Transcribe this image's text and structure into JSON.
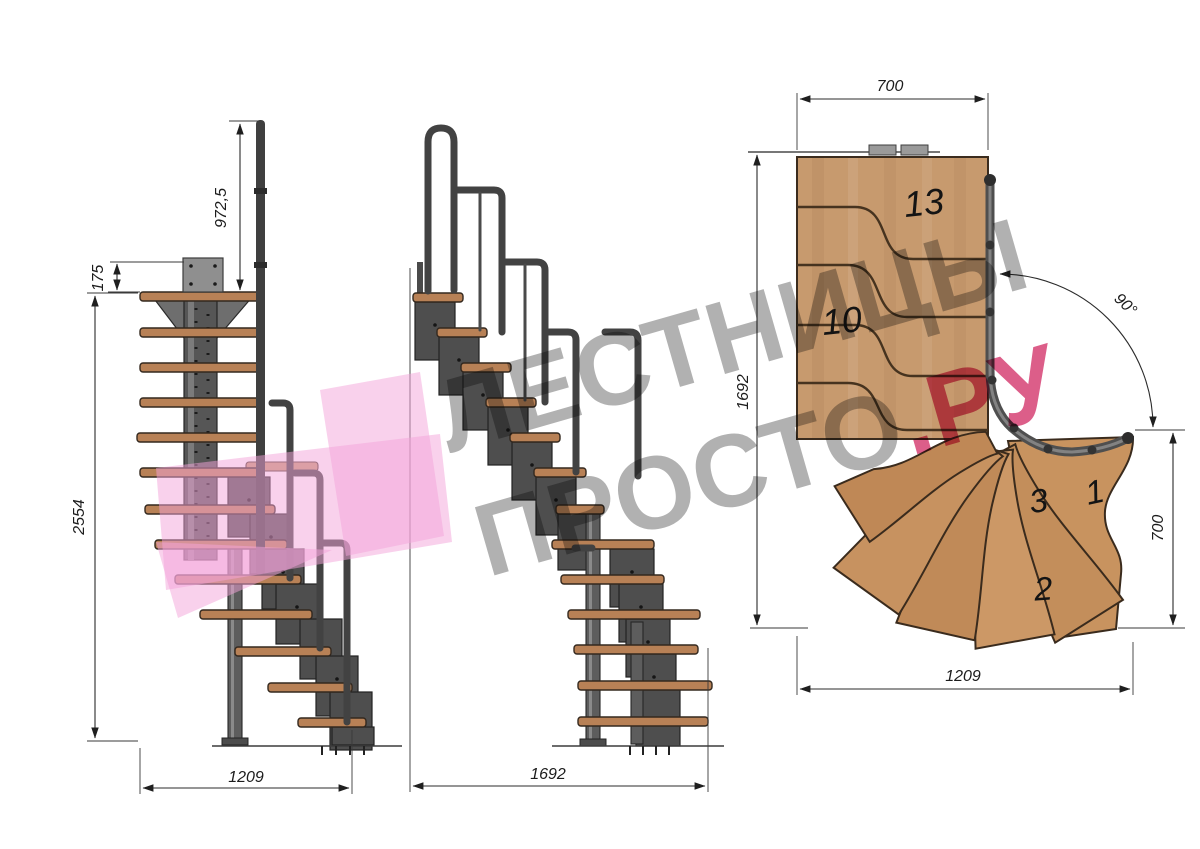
{
  "watermark": {
    "line1": "ЛЕСТНИЦЫ",
    "line2_gray": "ПРОСТО",
    "line2_pink": ".РУ"
  },
  "side_view_dims": {
    "rail_height": "972,5",
    "mount_offset": "175",
    "total_height": "2554",
    "base_width": "1209"
  },
  "front_view_dims": {
    "base_length": "1692"
  },
  "plan_dims": {
    "top_width": "700",
    "side_length": "1692",
    "bottom_width": "1209",
    "right_width": "700",
    "turn_angle": "90°"
  },
  "plan_tread_numbers": {
    "t13": "13",
    "t10": "10",
    "t3": "3",
    "t1": "1",
    "t2": "2"
  },
  "colors": {
    "wood_elevation": "#b88156",
    "wood_plan": "#c79a6e",
    "steel": "#4e4e4e",
    "logo_pink": "#f3a9dc",
    "watermark_gray": "#9b9b9b",
    "watermark_pink": "#d43d6f"
  }
}
